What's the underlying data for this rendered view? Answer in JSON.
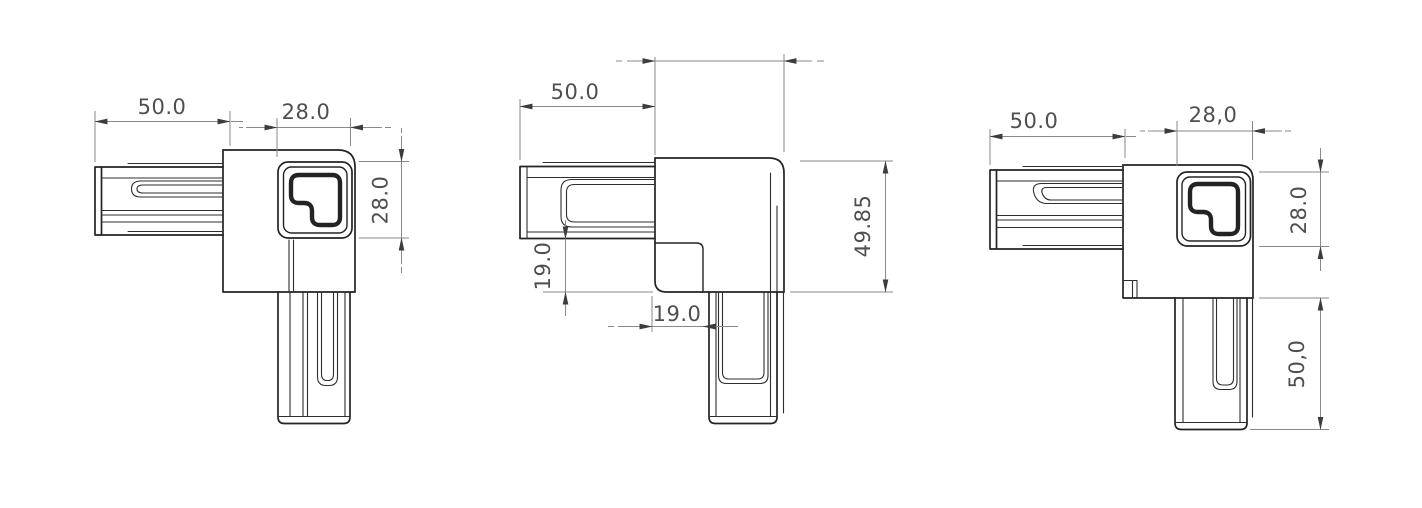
{
  "colors": {
    "background": "#ffffff",
    "edge": "#232323",
    "detail": "#2e2e2e",
    "dim-line": "#8a8a8a",
    "dim-text": "#4f4f4f",
    "arrow": "#3c3c3c"
  },
  "views": {
    "front": {
      "dims": {
        "arm_length": "50.0",
        "bore_width": "28.0",
        "bore_height": "28.0"
      }
    },
    "side": {
      "dims": {
        "arm_length": "50.0",
        "step_height": "19.0",
        "step_width": "19.0",
        "overall_height": "49.85"
      }
    },
    "back": {
      "dims": {
        "arm_length": "50.0",
        "bore_width": "28,0",
        "bore_height": "28.0",
        "leg_length": "50,0"
      }
    }
  }
}
